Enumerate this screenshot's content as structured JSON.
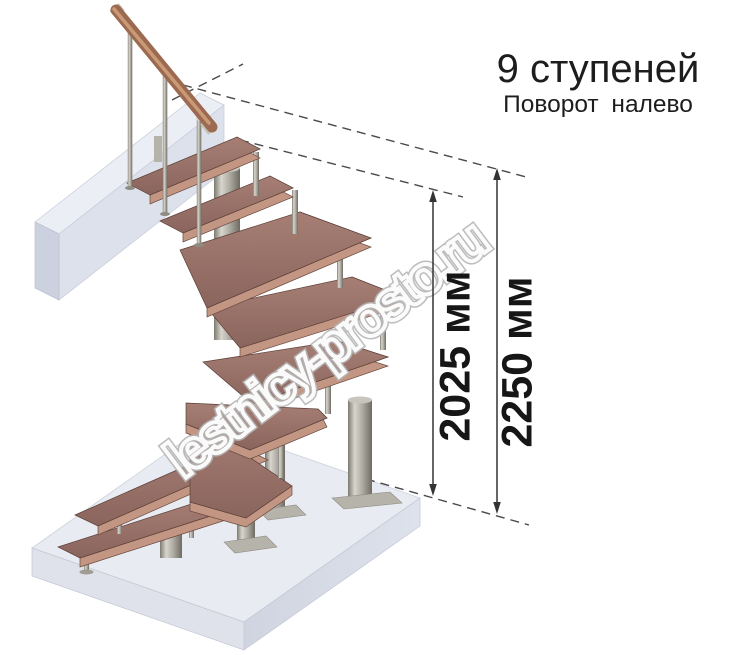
{
  "header": {
    "title": "9 ступеней",
    "subtitle": "Поворот налево"
  },
  "dimensions": {
    "stair_height_label": "2025 мм",
    "total_height_label": "2250 мм"
  },
  "watermark_text": "lestnicy-prosto.ru",
  "stair": {
    "steps_count": "9",
    "turn_direction": "налево",
    "treads_material": "wood",
    "frame_material": "metal"
  },
  "colors": {
    "tread": "#9a766c",
    "tread_edge": "#c39683",
    "metal": "#aaa79f",
    "handrail_wood": "#9c6a50",
    "floor_slab": "#e9ebf2",
    "dimension_text": "#161616",
    "watermark_outline": "#b5b5b5"
  }
}
